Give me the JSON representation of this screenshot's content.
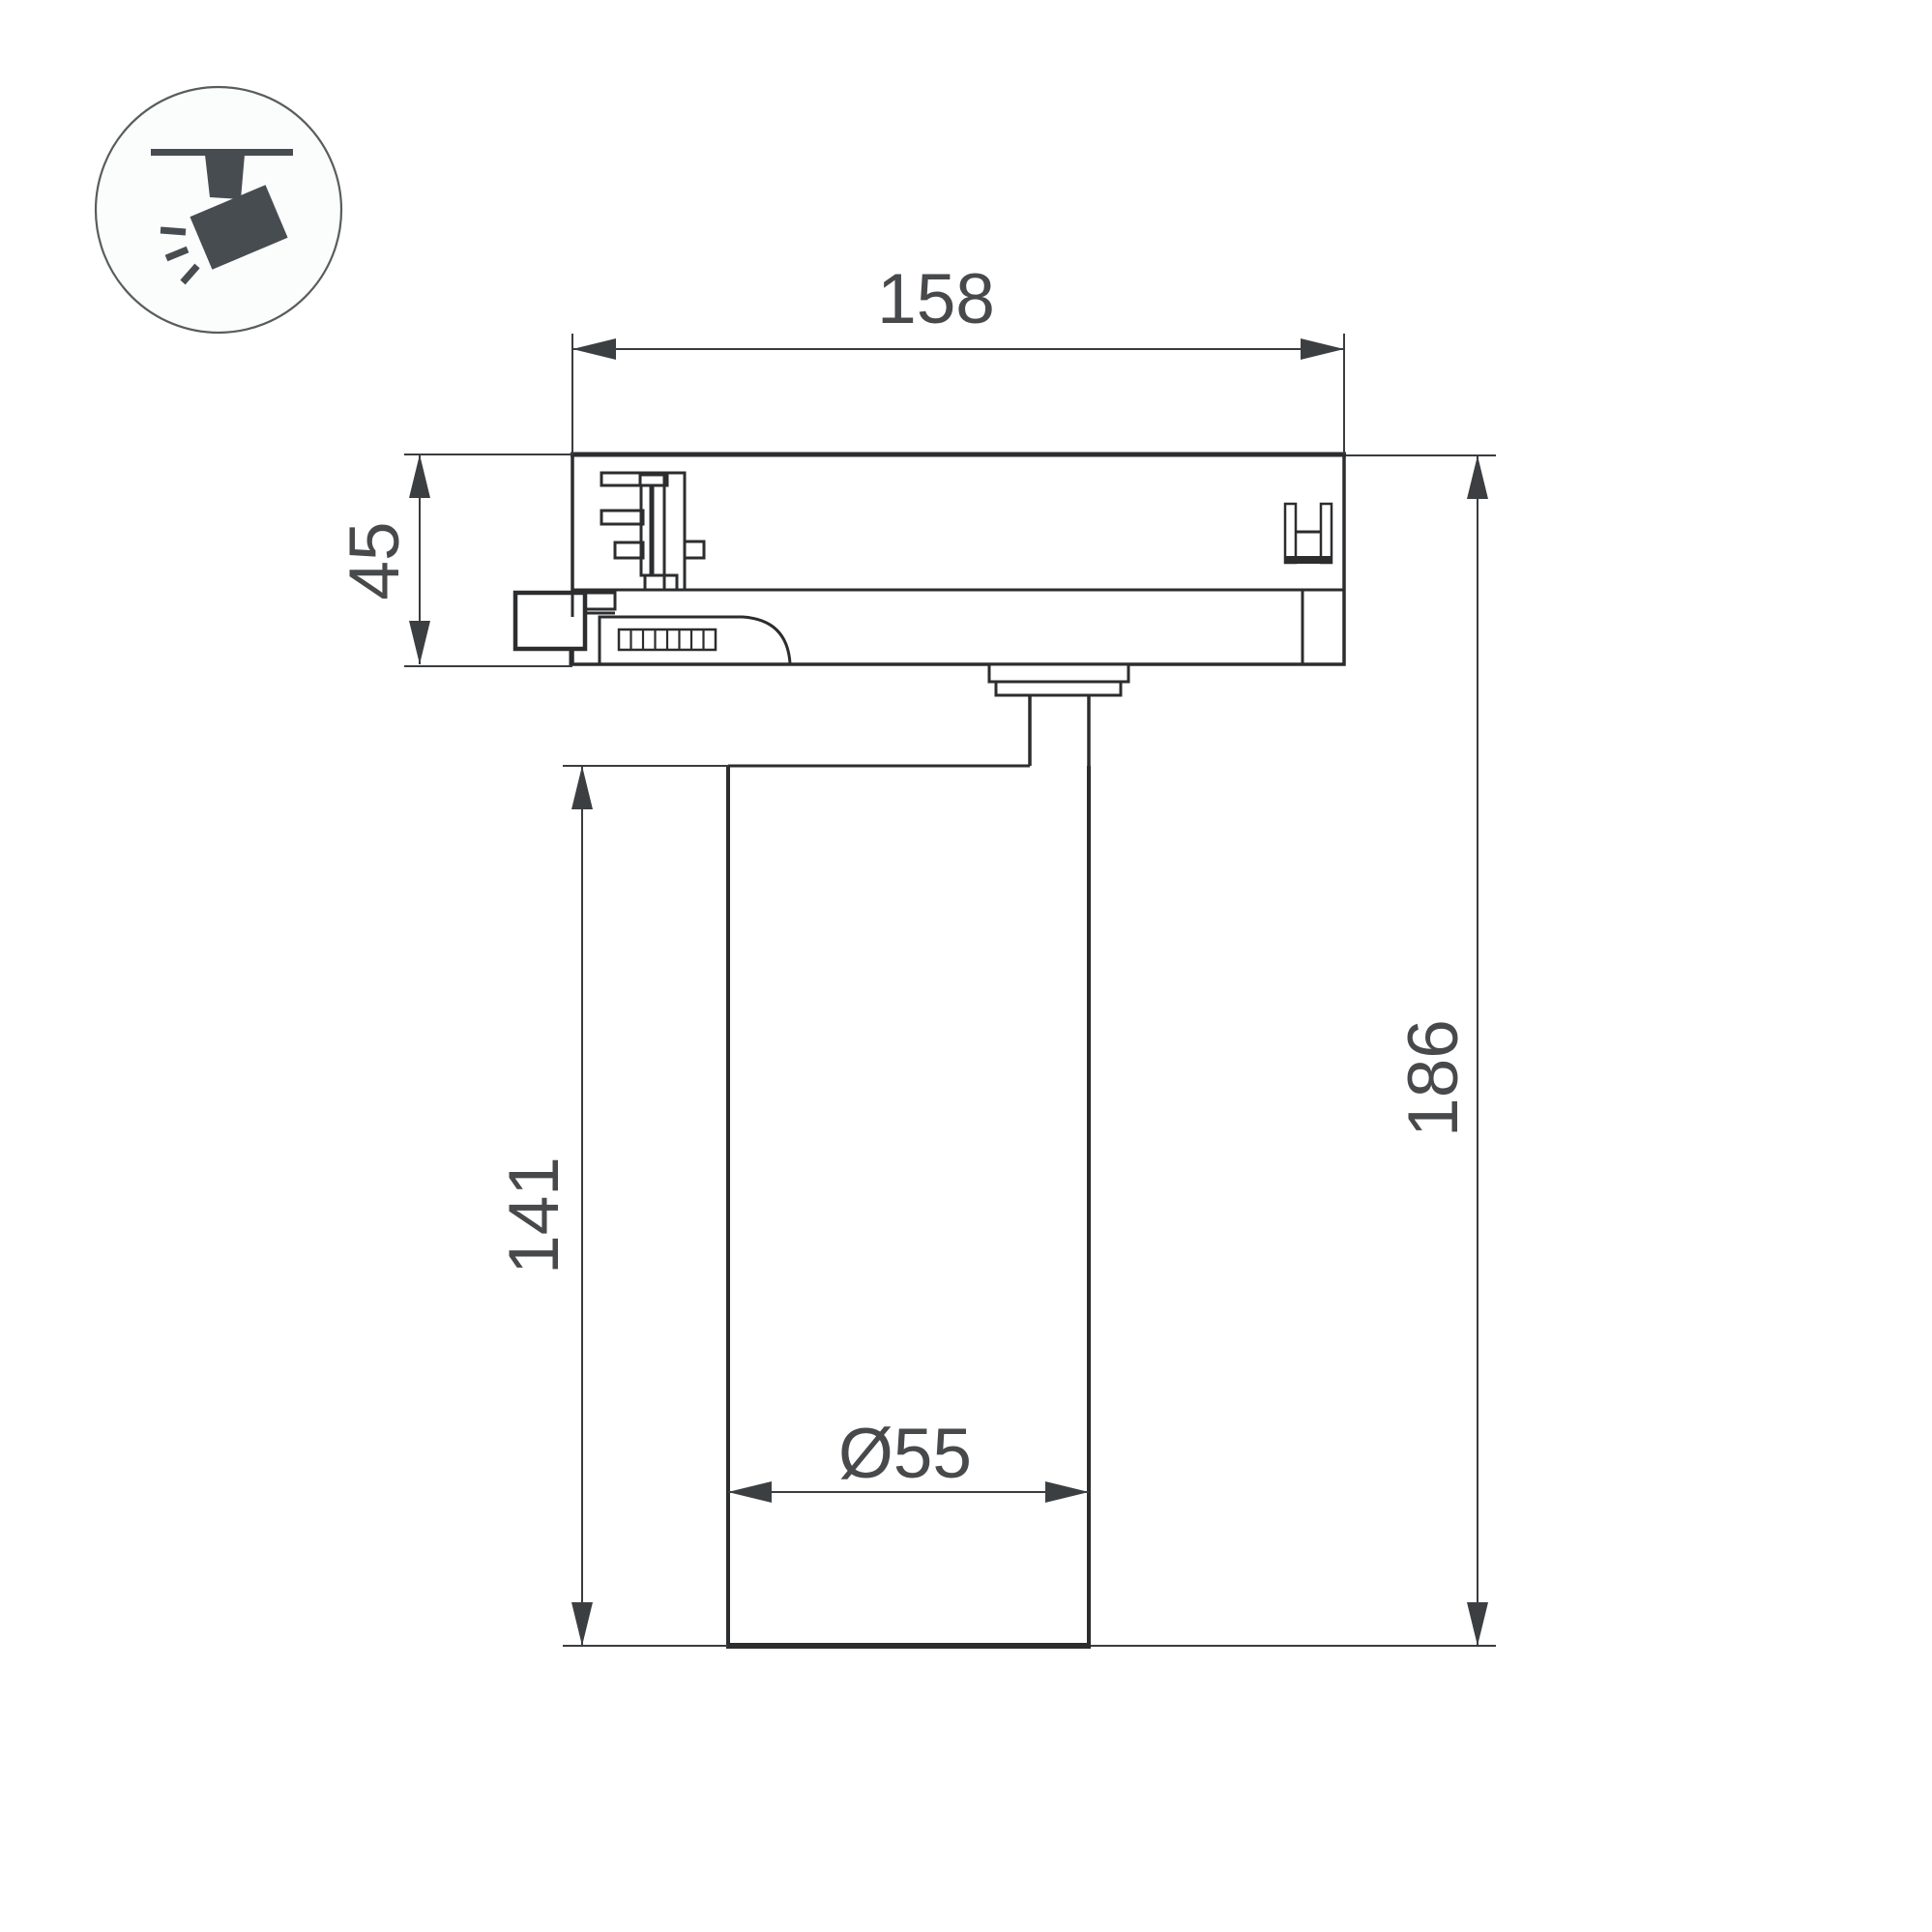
{
  "drawing": {
    "type": "technical-dimension-drawing",
    "subject": "track-mounted spotlight, side section view",
    "icon": {
      "name": "track-spotlight-pictogram",
      "description": "ceiling track with tilted spotlight head emitting rays"
    },
    "dimensions": {
      "track_adapter_width": "158",
      "track_adapter_height": "45",
      "body_height": "141",
      "total_height": "186",
      "body_diameter": "Ø55"
    },
    "colors": {
      "background": "#ffffff",
      "line": "#2c2d2f",
      "dim_line": "#3a3c3e",
      "arrow": "#3c3f41",
      "text": "#47494b",
      "icon_fill": "#474c50",
      "icon_circle_stroke": "#595c5e"
    }
  }
}
